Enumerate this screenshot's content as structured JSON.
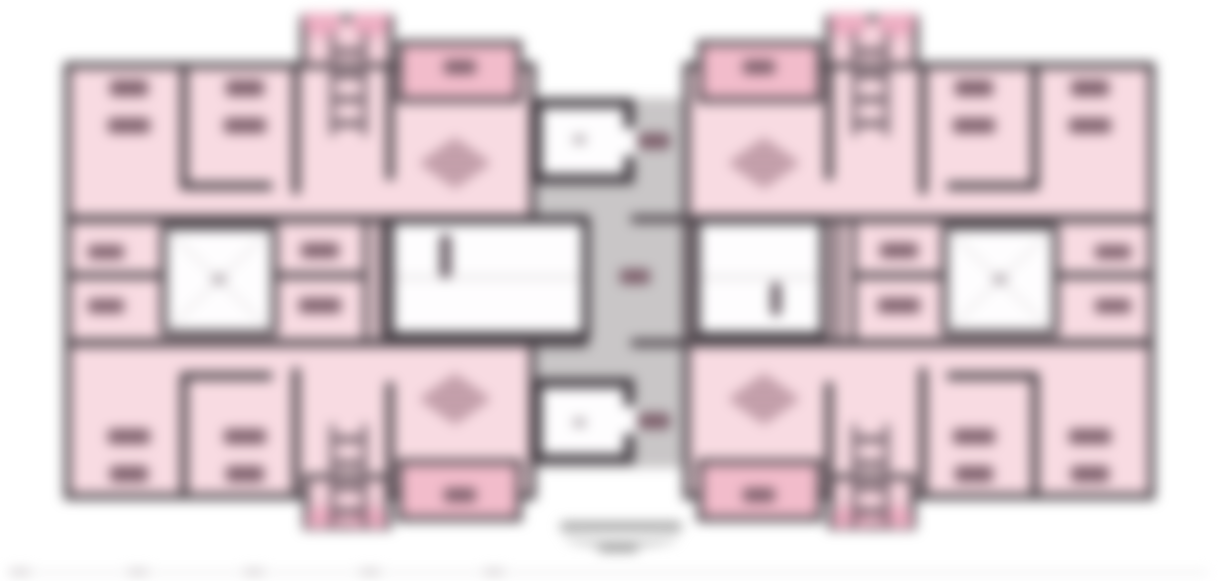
{
  "figure": {
    "kind": "blurred-architectural-floor-plan",
    "description": "Symmetric residential tower typical floor plan, two mirrored apartment wings joined by a central grey lift-lobby corridor; all text labels are blurred beyond legibility",
    "readable_text": []
  },
  "palette": {
    "page": "#ffffff",
    "room_pink": "#f8dbe2",
    "balcony_pink": "#f2bccb",
    "appendage_pink": "#f6d4dd",
    "bump_pink": "#eeaec3",
    "corridor_gray": "#c9c6c7",
    "room_white": "#fefdfe",
    "wall_dark": "#4b4349",
    "core_wall_dark": "#3f393f",
    "label_blob": "#7d5f6b",
    "ladder_dark": "#6b5a63",
    "stair_mark": "#5f525b",
    "diamond_dark": "#8d6774",
    "diamond_light": "#ecc9d3",
    "faint_line": "#dcd7d9",
    "dot_gray": "#b3abb0",
    "caption_gray": "#9b9b9b",
    "ruler_line": "#e8e6e7",
    "ruler_tick": "#cfcacd"
  },
  "meta": {
    "width": 1218,
    "height": 581,
    "mirror_x_sum": 1219,
    "mirror_y_sum": 562,
    "blur_px": 6
  },
  "elements": [
    {
      "name": "central-corridor",
      "x": 536,
      "y": 98,
      "w": 156,
      "h": 370,
      "fill": "corridor_gray"
    },
    {
      "name": "apartment-wing",
      "x": 64,
      "y": 62,
      "w": 472,
      "h": 438,
      "fill": "room_pink",
      "bw": 7,
      "bc": "wall_dark",
      "mx": true
    },
    {
      "name": "balcony-strip",
      "x": 396,
      "y": 40,
      "w": 126,
      "h": 63,
      "fill": "balcony_pink",
      "bw": 6,
      "bc": "wall_dark",
      "mx": true,
      "my": true
    },
    {
      "name": "stair-appendage-top",
      "x": 300,
      "y": 15,
      "w": 94,
      "h": 54,
      "fill": "appendage_pink",
      "bw": 6,
      "bc": "wall_dark",
      "mx": true
    },
    {
      "name": "stair-appendage-bottom",
      "x": 303,
      "y": 474,
      "w": 88,
      "h": 56,
      "fill": "appendage_pink",
      "bw": 6,
      "bc": "wall_dark",
      "mx": true
    },
    {
      "name": "appendage-bump",
      "x": 304,
      "y": 13,
      "w": 37,
      "h": 24,
      "fill": "bump_pink",
      "r": "0 0 14px 14px",
      "mx": true
    },
    {
      "name": "appendage-bump",
      "x": 352,
      "y": 13,
      "w": 37,
      "h": 24,
      "fill": "bump_pink",
      "r": "0 0 14px 14px",
      "mx": true
    },
    {
      "name": "appendage-bump",
      "x": 307,
      "y": 506,
      "w": 37,
      "h": 22,
      "fill": "bump_pink",
      "r": "14px 14px 0 0",
      "mx": true
    },
    {
      "name": "appendage-bump",
      "x": 349,
      "y": 506,
      "w": 37,
      "h": 22,
      "fill": "bump_pink",
      "r": "14px 14px 0 0",
      "mx": true
    },
    {
      "name": "wall-vertical",
      "x": 180,
      "y": 62,
      "w": 8,
      "h": 128,
      "fill": "wall_dark",
      "mx": true,
      "my": true
    },
    {
      "name": "wall-horizontal",
      "x": 180,
      "y": 182,
      "w": 92,
      "h": 8,
      "fill": "wall_dark",
      "mx": true,
      "my": true
    },
    {
      "name": "wall-vertical",
      "x": 292,
      "y": 62,
      "w": 8,
      "h": 132,
      "fill": "wall_dark",
      "mx": true,
      "my": true
    },
    {
      "name": "wall-vertical",
      "x": 386,
      "y": 62,
      "w": 8,
      "h": 118,
      "fill": "wall_dark",
      "mx": true,
      "my": true
    },
    {
      "name": "wall-band",
      "x": 64,
      "y": 215,
      "w": 524,
      "h": 8,
      "fill": "wall_dark",
      "mx": true,
      "my": true
    },
    {
      "name": "lightwell-room",
      "x": 160,
      "y": 223,
      "w": 118,
      "h": 114,
      "fill": "room_white",
      "bw": 7,
      "bc": "wall_dark",
      "mx": true
    },
    {
      "name": "lightwell-diagonal",
      "x": 141,
      "y": 279,
      "w": 156,
      "h": 2,
      "fill": "faint_line",
      "rot": 44,
      "mx": true
    },
    {
      "name": "lightwell-diagonal",
      "x": 141,
      "y": 279,
      "w": 156,
      "h": 2,
      "fill": "faint_line",
      "rot": -44,
      "mx": true
    },
    {
      "name": "lightwell-center-mark",
      "x": 212,
      "y": 274,
      "w": 14,
      "h": 10,
      "fill": "dot_gray",
      "r": "3px",
      "mx": true
    },
    {
      "name": "wall-divider",
      "x": 278,
      "y": 272,
      "w": 86,
      "h": 7,
      "fill": "wall_dark",
      "mx": true
    },
    {
      "name": "wall-divider",
      "x": 64,
      "y": 272,
      "w": 96,
      "h": 7,
      "fill": "wall_dark",
      "mx": true
    },
    {
      "name": "double-wall",
      "x": 363,
      "y": 215,
      "w": 6,
      "h": 130,
      "fill": "wall_dark",
      "mx": true
    },
    {
      "name": "double-wall",
      "x": 379,
      "y": 215,
      "w": 6,
      "h": 130,
      "fill": "wall_dark",
      "mx": true
    },
    {
      "name": "stairwell-left",
      "x": 386,
      "y": 216,
      "w": 204,
      "h": 124,
      "fill": "room_white",
      "bw": 8,
      "bc": "core_wall_dark",
      "stairs": true
    },
    {
      "name": "stairwell-right",
      "x": 692,
      "y": 216,
      "w": 136,
      "h": 124,
      "fill": "room_white",
      "bw": 8,
      "bc": "core_wall_dark",
      "stairs": true
    },
    {
      "name": "stair-mid-landing-line",
      "x": 394,
      "y": 276,
      "w": 188,
      "h": 3,
      "fill": "faint_line"
    },
    {
      "name": "stair-mid-landing-line",
      "x": 700,
      "y": 276,
      "w": 120,
      "h": 3,
      "fill": "faint_line"
    },
    {
      "name": "stair-direction-arrow",
      "x": 440,
      "y": 234,
      "w": 11,
      "h": 44,
      "fill": "stair_mark",
      "r": "5px"
    },
    {
      "name": "stair-direction-arrow",
      "x": 771,
      "y": 282,
      "w": 10,
      "h": 34,
      "fill": "stair_mark",
      "r": "5px"
    },
    {
      "name": "lift-lobby",
      "x": 532,
      "y": 98,
      "w": 102,
      "h": 86,
      "fill": "room_white",
      "bw": 10,
      "bc": "core_wall_dark",
      "my": true
    },
    {
      "name": "lift-lobby-opening",
      "x": 624,
      "y": 128,
      "w": 12,
      "h": 28,
      "fill": "room_white",
      "my": true
    },
    {
      "name": "lift-lobby-mark",
      "x": 573,
      "y": 135,
      "w": 13,
      "h": 9,
      "fill": "dot_gray",
      "r": "3px",
      "my": true
    },
    {
      "name": "ladder-rail",
      "x": 330,
      "y": 32,
      "w": 5,
      "h": 104,
      "fill": "ladder_dark",
      "mx": true
    },
    {
      "name": "ladder-rail",
      "x": 362,
      "y": 32,
      "w": 5,
      "h": 104,
      "fill": "ladder_dark",
      "mx": true
    },
    {
      "name": "ladder-rung",
      "x": 330,
      "y": 48,
      "w": 37,
      "h": 7,
      "fill": "ladder_dark",
      "mx": true
    },
    {
      "name": "ladder-rung",
      "x": 330,
      "y": 72,
      "w": 37,
      "h": 7,
      "fill": "ladder_dark",
      "mx": true
    },
    {
      "name": "ladder-rung",
      "x": 330,
      "y": 96,
      "w": 37,
      "h": 7,
      "fill": "ladder_dark",
      "mx": true
    },
    {
      "name": "ladder-rung",
      "x": 330,
      "y": 120,
      "w": 37,
      "h": 7,
      "fill": "ladder_dark",
      "mx": true
    },
    {
      "name": "ladder-rail",
      "x": 330,
      "y": 424,
      "w": 5,
      "h": 104,
      "fill": "ladder_dark",
      "mx": true
    },
    {
      "name": "ladder-rail",
      "x": 362,
      "y": 424,
      "w": 5,
      "h": 104,
      "fill": "ladder_dark",
      "mx": true
    },
    {
      "name": "ladder-rung",
      "x": 330,
      "y": 436,
      "w": 37,
      "h": 7,
      "fill": "ladder_dark",
      "mx": true
    },
    {
      "name": "ladder-rung",
      "x": 330,
      "y": 460,
      "w": 37,
      "h": 7,
      "fill": "ladder_dark",
      "mx": true
    },
    {
      "name": "ladder-rung",
      "x": 330,
      "y": 484,
      "w": 37,
      "h": 7,
      "fill": "ladder_dark",
      "mx": true
    },
    {
      "name": "ladder-rung",
      "x": 330,
      "y": 508,
      "w": 37,
      "h": 7,
      "fill": "ladder_dark",
      "mx": true
    },
    {
      "name": "room-label-blob",
      "x": 110,
      "y": 80,
      "w": 38,
      "h": 16,
      "fill": "label_blob",
      "r": "3px",
      "mx": true,
      "my": true
    },
    {
      "name": "room-label-blob",
      "x": 108,
      "y": 118,
      "w": 42,
      "h": 15,
      "fill": "label_blob",
      "r": "3px",
      "mx": true,
      "my": true
    },
    {
      "name": "room-label-blob",
      "x": 226,
      "y": 80,
      "w": 38,
      "h": 16,
      "fill": "label_blob",
      "r": "3px",
      "mx": true,
      "my": true
    },
    {
      "name": "room-label-blob",
      "x": 224,
      "y": 118,
      "w": 42,
      "h": 15,
      "fill": "label_blob",
      "r": "3px",
      "mx": true,
      "my": true
    },
    {
      "name": "balcony-label-blob",
      "x": 444,
      "y": 60,
      "w": 32,
      "h": 14,
      "fill": "label_blob",
      "r": "3px",
      "mx": true,
      "my": true
    },
    {
      "name": "room-label-blob",
      "x": 301,
      "y": 243,
      "w": 38,
      "h": 15,
      "fill": "label_blob",
      "r": "3px",
      "mx": true
    },
    {
      "name": "room-label-blob",
      "x": 299,
      "y": 298,
      "w": 42,
      "h": 15,
      "fill": "label_blob",
      "r": "3px",
      "mx": true
    },
    {
      "name": "room-label-blob",
      "x": 88,
      "y": 245,
      "w": 36,
      "h": 14,
      "fill": "label_blob",
      "r": "3px",
      "mx": true
    },
    {
      "name": "room-label-blob",
      "x": 88,
      "y": 299,
      "w": 36,
      "h": 14,
      "fill": "label_blob",
      "r": "3px",
      "mx": true
    },
    {
      "name": "corridor-label-blob",
      "x": 638,
      "y": 133,
      "w": 32,
      "h": 16,
      "fill": "label_blob",
      "r": "3px",
      "my": true
    },
    {
      "name": "corridor-label-blob",
      "x": 620,
      "y": 269,
      "w": 30,
      "h": 15,
      "fill": "label_blob",
      "r": "3px"
    },
    {
      "name": "hatched-diamond-symbol",
      "x": 418,
      "y": 137,
      "w": 74,
      "h": 52,
      "type": "diamond",
      "mx": true,
      "my": true
    },
    {
      "name": "caption-text-blob",
      "x": 560,
      "y": 522,
      "w": 122,
      "h": 9,
      "fill": "caption_gray",
      "r": "4px"
    },
    {
      "name": "caption-underline-swoosh",
      "x": 563,
      "y": 528,
      "w": 116,
      "h": 18,
      "type": "arc"
    },
    {
      "name": "caption-text-blob",
      "x": 598,
      "y": 546,
      "w": 40,
      "h": 6,
      "fill": "caption_gray",
      "r": "3px"
    },
    {
      "name": "scale-ruler-line",
      "x": 8,
      "y": 571,
      "w": 1200,
      "h": 3,
      "fill": "ruler_line"
    },
    {
      "name": "scale-ruler-tick",
      "x": 10,
      "y": 569,
      "w": 20,
      "h": 6,
      "fill": "ruler_tick"
    },
    {
      "name": "scale-ruler-tick",
      "x": 128,
      "y": 569,
      "w": 20,
      "h": 6,
      "fill": "ruler_tick"
    },
    {
      "name": "scale-ruler-tick",
      "x": 244,
      "y": 569,
      "w": 20,
      "h": 6,
      "fill": "ruler_tick"
    },
    {
      "name": "scale-ruler-tick",
      "x": 360,
      "y": 569,
      "w": 20,
      "h": 6,
      "fill": "ruler_tick"
    },
    {
      "name": "scale-ruler-tick",
      "x": 484,
      "y": 569,
      "w": 20,
      "h": 6,
      "fill": "ruler_tick"
    }
  ]
}
